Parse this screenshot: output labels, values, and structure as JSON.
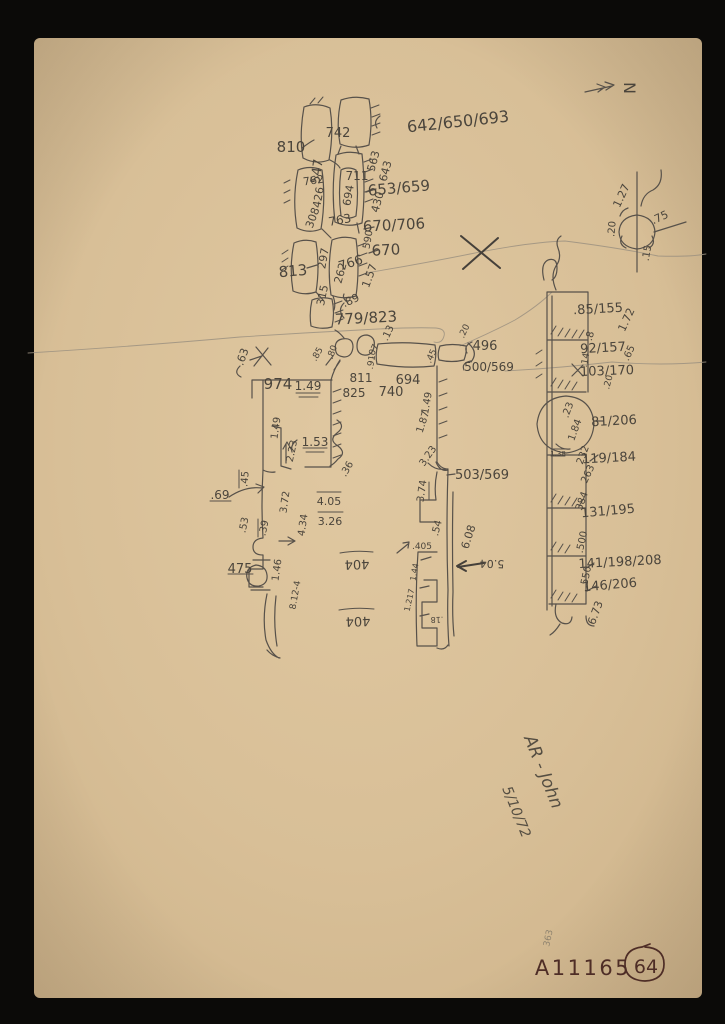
{
  "sketch": {
    "top_wall": [
      "810",
      "742",
      "642/650/693",
      "547",
      "762",
      "711",
      "563",
      "643",
      "694",
      "653/659",
      "430",
      "426",
      "308",
      "763",
      "670/706",
      "590",
      "670",
      "766",
      "297",
      "813",
      "262",
      "1.57",
      "315",
      ".89",
      "779/823"
    ],
    "compass": [
      "N",
      "1.27",
      ".75",
      ".20",
      ".15"
    ],
    "east_wall": [
      ".85/155",
      "1.72",
      ".8",
      "92/157",
      ".65",
      ".14",
      "103/170",
      ".20",
      ".23",
      "1.84",
      "81/206",
      "1.38",
      "232",
      "119/184",
      "263",
      "384",
      "131/195",
      ".500",
      "141/198/208",
      ".550",
      "146/206",
      "6.73"
    ],
    "central": [
      ".63",
      "974",
      "1.49",
      ".85",
      ".80",
      ".07",
      ".91",
      ".13",
      "811",
      "825",
      "740",
      "694",
      "496",
      "500/569",
      ".45",
      ".20",
      "1.49",
      "1.87",
      "503/569",
      "3.23",
      "3.74",
      ".54",
      "6.08",
      ".405",
      "5.04",
      "1.44",
      "1.217",
      ".18"
    ],
    "west": [
      "1.53",
      "2.23",
      "1.49",
      ".36",
      ".45",
      ".69",
      "3.72",
      "4.05",
      ".53",
      ".39",
      "3.26",
      "4.34",
      "475",
      "1.46",
      "8.12-4",
      "404",
      "404"
    ]
  },
  "signature": {
    "line1": "AR - John",
    "line2": "5/10/72"
  },
  "catalog": {
    "number": "A11165",
    "circled_number": "64",
    "faint_note": "363"
  },
  "colors": {
    "paper": "#d9c098",
    "pencil": "#57514a",
    "ink": "#4e2d26",
    "background": "#0b0a08"
  }
}
